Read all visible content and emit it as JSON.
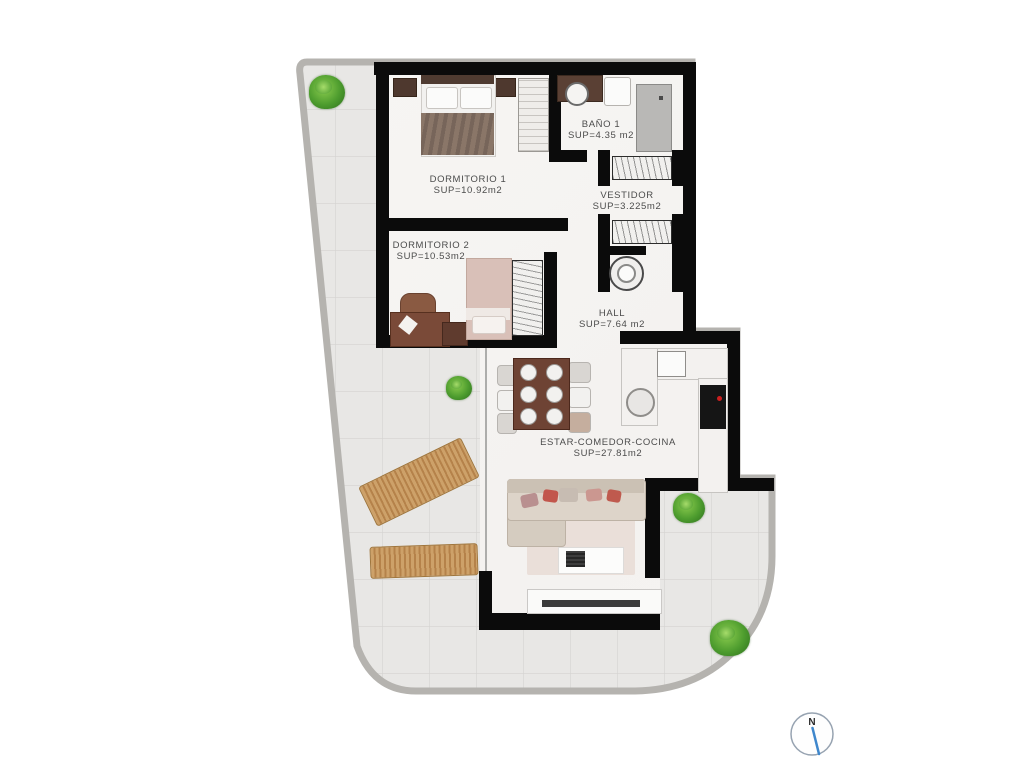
{
  "floorplan": {
    "rooms": [
      {
        "name": "DORMITORIO 1",
        "area": "SUP=10.92m2"
      },
      {
        "name": "DORMITORIO 2",
        "area": "SUP=10.53m2"
      },
      {
        "name": "BAÑO 1",
        "area": "SUP=4.35 m2"
      },
      {
        "name": "VESTIDOR",
        "area": "SUP=3.225m2"
      },
      {
        "name": "HALL",
        "area": "SUP=7.64 m2"
      },
      {
        "name": "ESTAR-COMEDOR-COCINA",
        "area": "SUP=27.81m2"
      }
    ],
    "compass": {
      "label": "N",
      "needle_color": "#3f87cc",
      "ring_color": "#97a3b1"
    },
    "colors": {
      "wall": "#0b0b0b",
      "terrace_tile": "#e8e7e5",
      "tile_grid_line": "#d4d3d1",
      "terrace_curb": "#b5b3af",
      "interior_floor": "#f7f5f3",
      "lounger_wood": "#c59a62",
      "plant_green": "#4d9c2e",
      "bed1_blanket": "#7f6c60",
      "bed2_blanket": "#d9c0b8",
      "sofa_beige": "#d5ccc0",
      "dining_table_wood": "#6e4334",
      "cooktop": "#151515",
      "cooktop_dot": "#cc1f1f"
    },
    "furniture": [
      "double-bed",
      "single-bed",
      "nightstand",
      "wardrobe",
      "desk",
      "desk-chair",
      "washbasin",
      "toilet",
      "shower",
      "washing-machine",
      "dining-table",
      "dining-chair",
      "kitchen-counter",
      "kitchen-sink",
      "fridge",
      "cooktop",
      "sofa",
      "rug",
      "coffee-table",
      "tv-cabinet",
      "sun-lounger",
      "plant"
    ]
  }
}
